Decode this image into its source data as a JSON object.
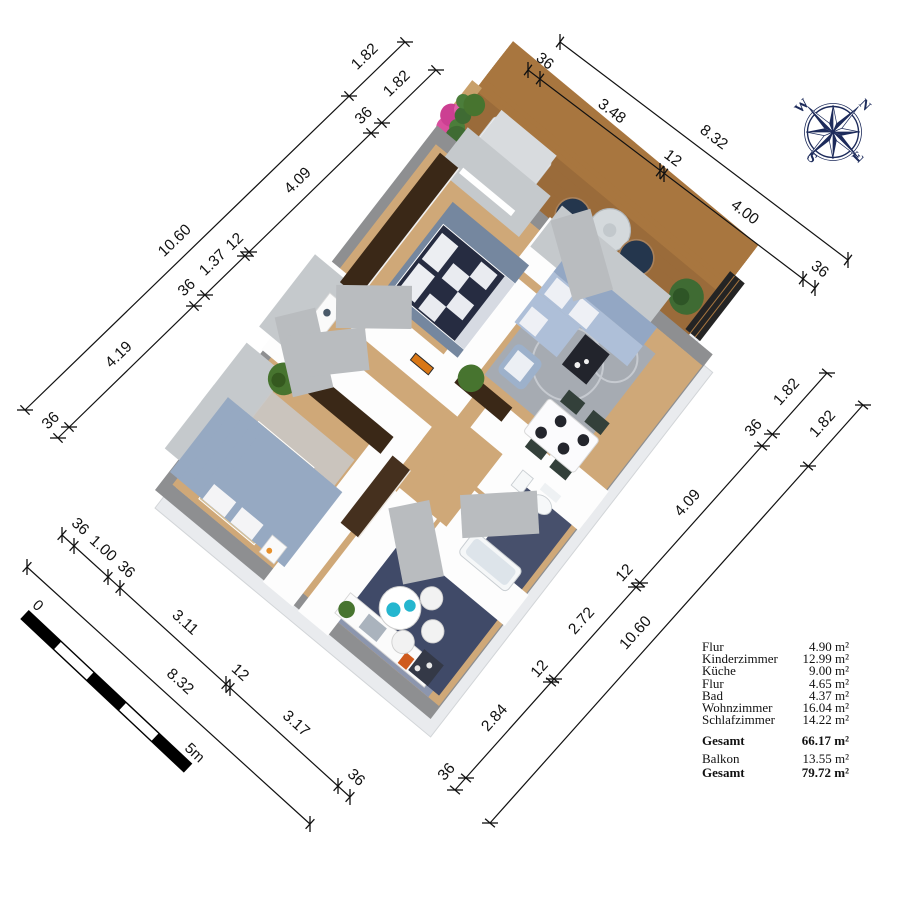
{
  "legend": {
    "rows": [
      {
        "label": "Flur",
        "value": "4.90 m²"
      },
      {
        "label": "Kinderzimmer",
        "value": "12.99 m²"
      },
      {
        "label": "Küche",
        "value": "9.00 m²"
      },
      {
        "label": "Flur",
        "value": "4.65 m²"
      },
      {
        "label": "Bad",
        "value": "4.37 m²"
      },
      {
        "label": "Wohnzimmer",
        "value": "16.04 m²"
      },
      {
        "label": "Schlafzimmer",
        "value": "14.22 m²"
      },
      {
        "label": "Gesamt",
        "value": "66.17 m²"
      },
      {
        "label": "Balkon",
        "value": "13.55 m²"
      },
      {
        "label": "Gesamt",
        "value": "79.72 m²"
      }
    ]
  },
  "dimensions": {
    "nw": {
      "outer": [
        "10.60",
        "1.82"
      ],
      "inner": [
        "36",
        "4.19",
        "36",
        "1.37",
        "12",
        "4.09",
        "36",
        "1.82"
      ]
    },
    "ne": {
      "outer": [
        "8.32"
      ],
      "inner": [
        "36",
        "3.48",
        "12",
        "4.00",
        "36"
      ]
    },
    "se": {
      "outer": [
        "10.60",
        "1.82"
      ],
      "inner": [
        "36",
        "2.84",
        "12",
        "2.72",
        "12",
        "4.09",
        "36",
        "1.82"
      ]
    },
    "sw": {
      "outer": [
        "8.32"
      ],
      "inner": [
        "36",
        "1.00",
        "36",
        "3.11",
        "12",
        "3.17",
        "36"
      ]
    }
  },
  "scale_bar": {
    "start": "0",
    "end": "5m"
  },
  "compass": {
    "north": "N",
    "east": "E",
    "south": "S",
    "west": "W"
  },
  "palette": {
    "wood_floor": "#e2bd8e",
    "balcony_deck": "#b5824f",
    "dark_tile": "#2d3349",
    "wall_gray": "#8e8f91",
    "compass_navy": "#1d2b5b",
    "flower_pink": "#d94f9e",
    "sofa_blue": "#aebfd8",
    "accent_orange": "#d97716"
  }
}
